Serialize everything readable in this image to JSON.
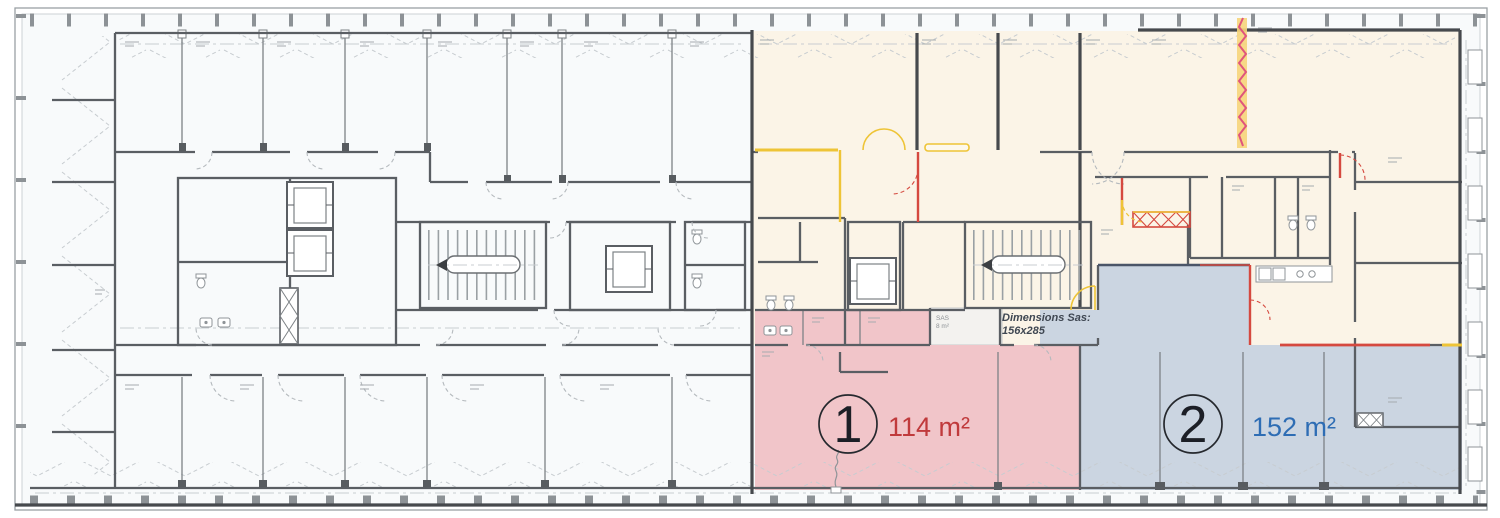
{
  "plan": {
    "zones": [
      {
        "id": "zone-1",
        "number": "1",
        "area_label": "114 m²",
        "fill": "#f1c5c9",
        "label_color": "#c03a3c"
      },
      {
        "id": "zone-2",
        "number": "2",
        "area_label": "152 m²",
        "fill": "#cbd5e1",
        "label_color": "#2e6db4"
      }
    ],
    "annotations": {
      "sas_dimensions_line1": "Dimensions Sas:",
      "sas_dimensions_line2": "156x285",
      "sas_room_label": "SAS",
      "sas_room_area": "8 m²"
    },
    "colors": {
      "existing_area_fill": "#fbf4e7",
      "left_wing_fill": "#f8fafb",
      "wall_gray": "#5a5e63",
      "new_partition_yellow": "#eec437",
      "modification_red": "#d5493f",
      "movable_partition_pink": "#e0557c"
    }
  }
}
